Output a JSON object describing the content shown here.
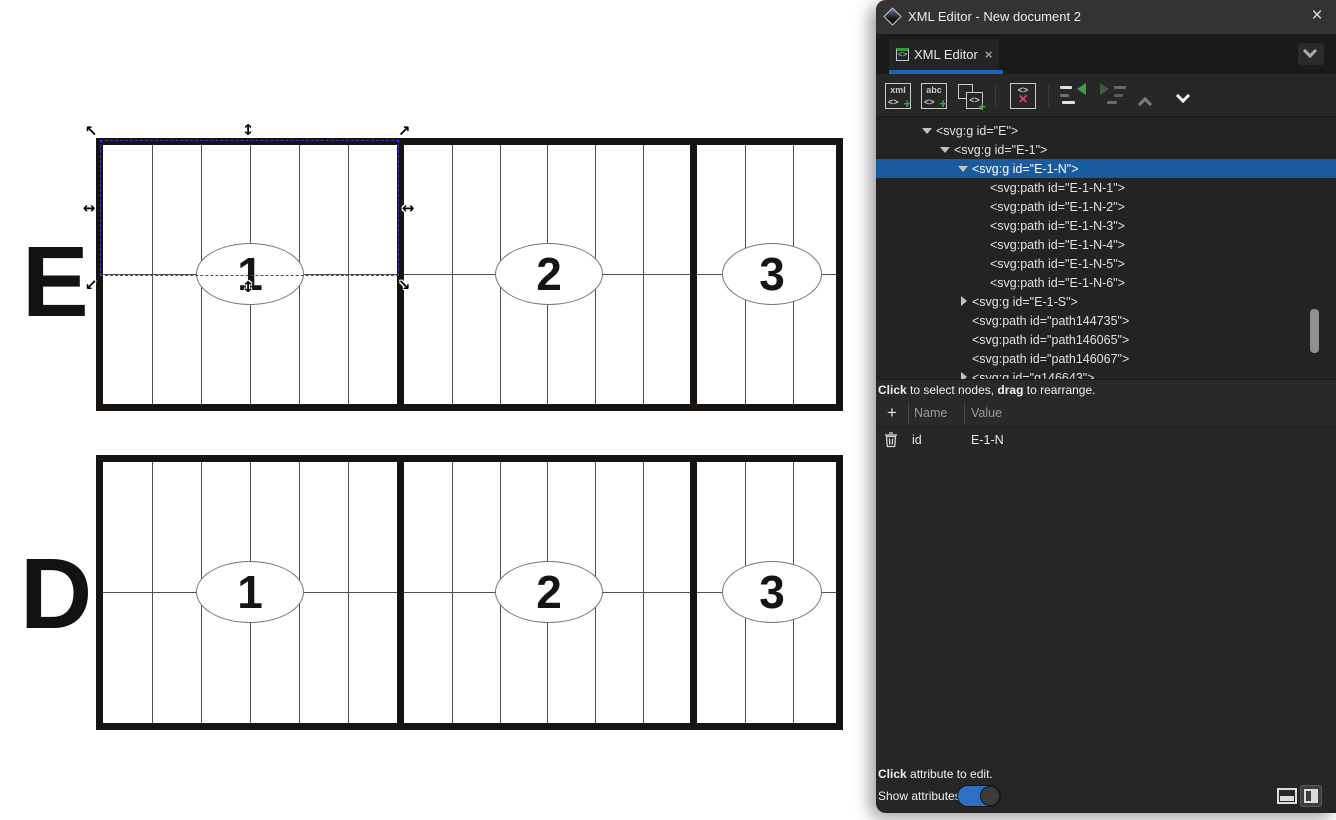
{
  "window": {
    "title": "XML Editor - New document 2",
    "close_glyph": "×"
  },
  "tab": {
    "icon_glyph": "<>",
    "label": "XML Editor",
    "close_glyph": "×"
  },
  "tab_overflow": {
    "name": "chevron-down"
  },
  "toolbar": {
    "buttons": [
      {
        "name": "new-element-node",
        "label1": "xml",
        "tag": "<>",
        "plus": "+"
      },
      {
        "name": "new-text-node",
        "label1": "abc",
        "tag": "<>",
        "plus": "+"
      },
      {
        "name": "duplicate-node",
        "tag": "<>",
        "plus": "+"
      },
      {
        "name": "delete-node",
        "tag": "<>",
        "x": "×"
      },
      {
        "name": "unindent-node"
      },
      {
        "name": "indent-node"
      },
      {
        "name": "move-up"
      },
      {
        "name": "move-down"
      }
    ]
  },
  "tree": {
    "hint": {
      "b1": "Click",
      "t1": " to select nodes, ",
      "b2": "drag",
      "t2": " to rearrange."
    },
    "nodes": [
      {
        "label": "<svg:g id=\"E\">",
        "level": 0,
        "state": "expanded",
        "selected": false
      },
      {
        "label": "<svg:g id=\"E-1\">",
        "level": 1,
        "state": "expanded",
        "selected": false
      },
      {
        "label": "<svg:g id=\"E-1-N\">",
        "level": 2,
        "state": "expanded",
        "selected": true
      },
      {
        "label": "<svg:path id=\"E-1-N-1\">",
        "level": 3,
        "state": "leaf",
        "selected": false
      },
      {
        "label": "<svg:path id=\"E-1-N-2\">",
        "level": 3,
        "state": "leaf",
        "selected": false
      },
      {
        "label": "<svg:path id=\"E-1-N-3\">",
        "level": 3,
        "state": "leaf",
        "selected": false
      },
      {
        "label": "<svg:path id=\"E-1-N-4\">",
        "level": 3,
        "state": "leaf",
        "selected": false
      },
      {
        "label": "<svg:path id=\"E-1-N-5\">",
        "level": 3,
        "state": "leaf",
        "selected": false
      },
      {
        "label": "<svg:path id=\"E-1-N-6\">",
        "level": 3,
        "state": "leaf",
        "selected": false
      },
      {
        "label": "<svg:g id=\"E-1-S\">",
        "level": 2,
        "state": "collapsed",
        "selected": false
      },
      {
        "label": "<svg:path id=\"path144735\">",
        "level": 2,
        "state": "leaf",
        "selected": false
      },
      {
        "label": "<svg:path id=\"path146065\">",
        "level": 2,
        "state": "leaf",
        "selected": false
      },
      {
        "label": "<svg:path id=\"path146067\">",
        "level": 2,
        "state": "leaf",
        "selected": false
      },
      {
        "label": "<svg:g id=\"g146643\">",
        "level": 2,
        "state": "collapsed",
        "selected": false
      }
    ]
  },
  "attributes": {
    "add_glyph": "+",
    "columns": {
      "name": "Name",
      "value": "Value"
    },
    "rows": [
      {
        "name": "id",
        "value": "E-1-N"
      }
    ]
  },
  "footer": {
    "hint": {
      "b1": "Click",
      "t1": " attribute to edit."
    },
    "toggle_label": "Show attributes",
    "toggle_on": true
  },
  "canvas": {
    "figures": [
      {
        "label": "E",
        "sections": [
          {
            "number": "1"
          },
          {
            "number": "2"
          },
          {
            "number": "3"
          }
        ]
      },
      {
        "label": "D",
        "sections": [
          {
            "number": "1"
          },
          {
            "number": "2"
          },
          {
            "number": "3"
          }
        ]
      }
    ],
    "selection": {
      "id": "E-1-N",
      "handles": {
        "nw": "↖",
        "n": "↕",
        "ne": "↗",
        "w": "↔",
        "e": "↔",
        "sw": "↙",
        "s": "↕",
        "se": "↘"
      }
    }
  },
  "colors": {
    "selection_blue": "#1a5a9e",
    "tab_underline": "#1d63bb",
    "toggle_blue": "#2d6fc3",
    "accent_green": "#3f9d42",
    "delete_pink": "#e23a8b"
  }
}
